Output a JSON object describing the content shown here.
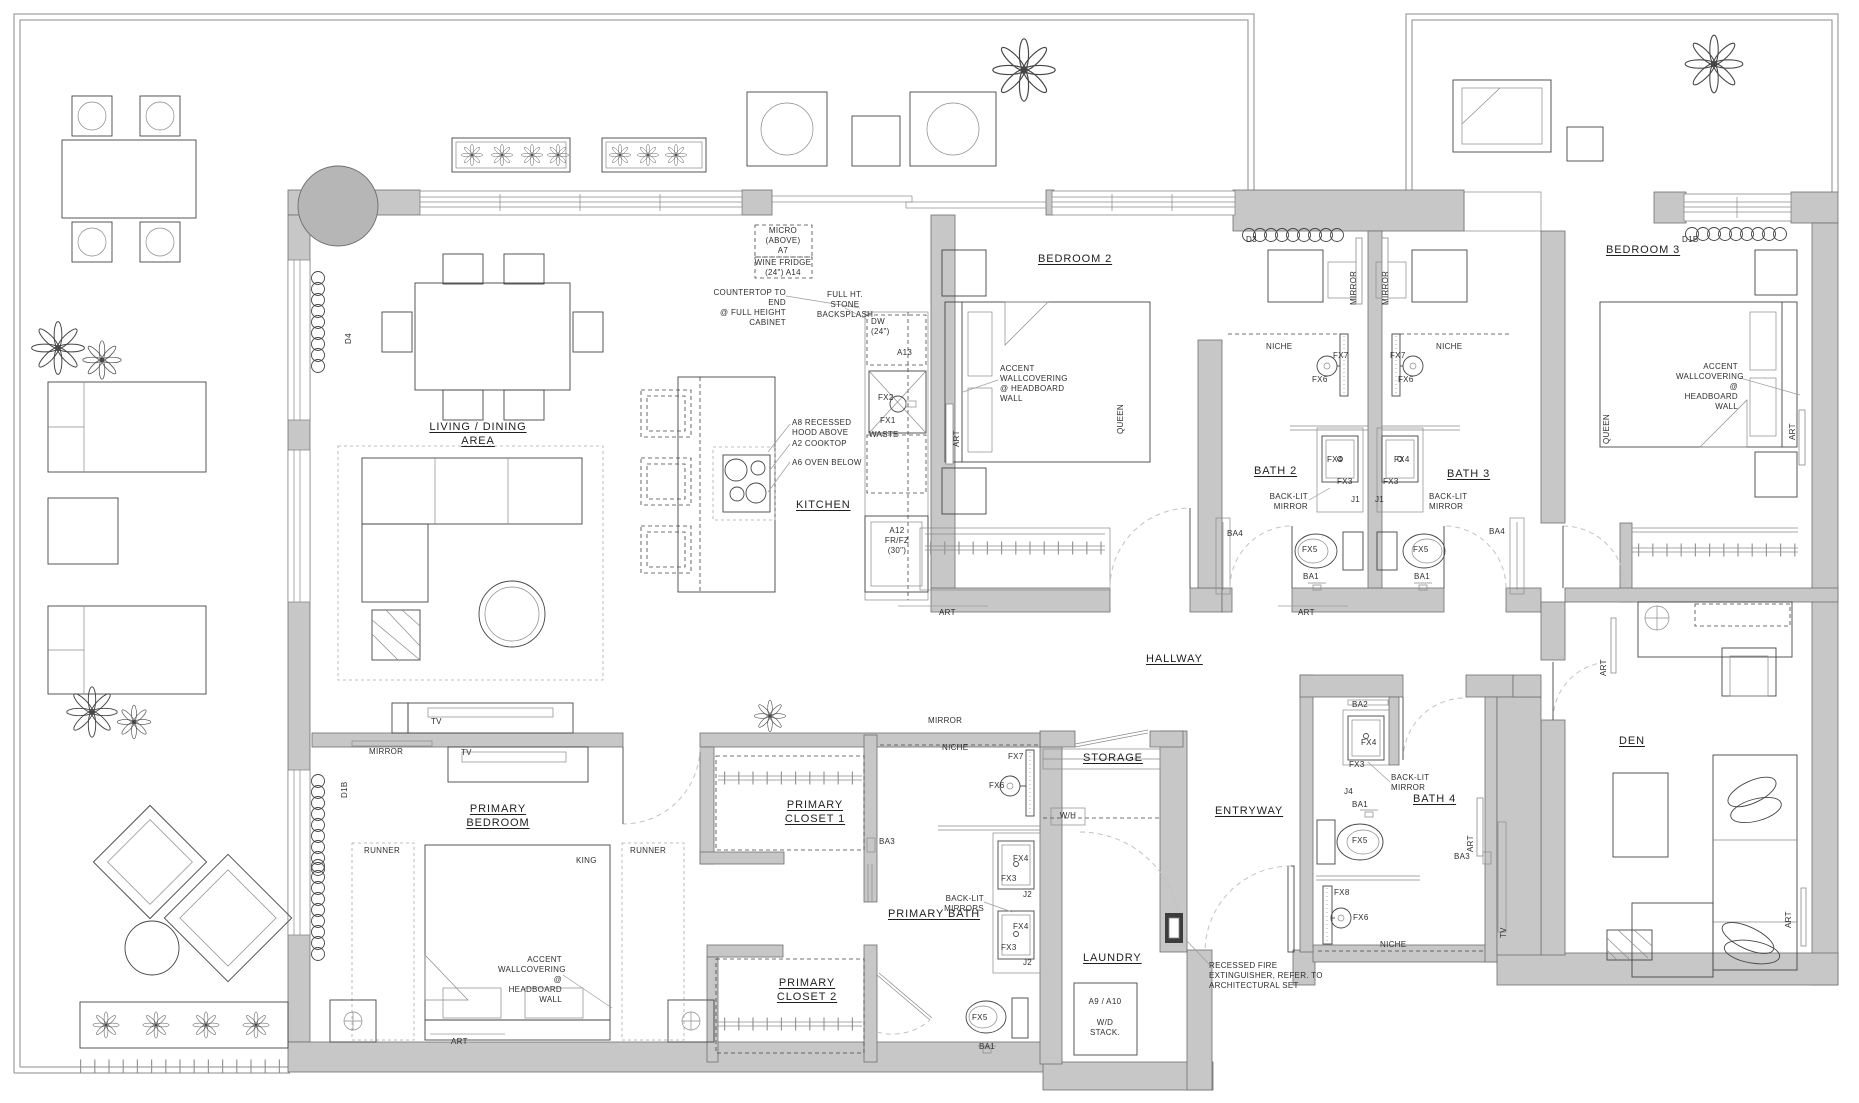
{
  "colors": {
    "wall_fill": "#c7c7c7",
    "line": "#454545",
    "plant_green": "#4f9f33",
    "door_swing": "#c2c2c2",
    "text": "#2e2e2e"
  },
  "rooms": {
    "living": "LIVING / DINING AREA",
    "kitchen": "KITCHEN",
    "bedroom2": "BEDROOM 2",
    "bedroom3": "BEDROOM 3",
    "bath2": "BATH 2",
    "bath3": "BATH 3",
    "bath4": "BATH 4",
    "primary_bedroom": "PRIMARY\nBEDROOM",
    "primary_closet1": "PRIMARY\nCLOSET 1",
    "primary_closet2": "PRIMARY\nCLOSET 2",
    "primary_bath": "PRIMARY BATH",
    "hallway": "HALLWAY",
    "storage": "STORAGE",
    "entryway": "ENTRYWAY",
    "laundry": "LAUNDRY",
    "den": "DEN"
  },
  "kitchen": {
    "micro": "MICRO\n(ABOVE)\nA7",
    "wine_fridge": "WINE FRIDGE\n(24\") A14",
    "countertop": "COUNTERTOP TO END\n@ FULL HEIGHT\nCABINET",
    "backsplash": "FULL HT. STONE\nBACKSPLASH",
    "dw": "DW\n(24\")",
    "a13": "A13",
    "fx2": "FX2",
    "fx1": "FX1",
    "waste": "WASTE",
    "fridge": "A12\nFR/FZ\n(30\")",
    "hood": "A8 RECESSED\nHOOD ABOVE",
    "cooktop": "A2 COOKTOP",
    "oven": "A6 OVEN BELOW"
  },
  "notes": {
    "accent": "ACCENT\nWALLCOVERING\n@ HEADBOARD\nWALL",
    "backlit": "BACK-LIT\nMIRROR",
    "backlit_plural": "BACK-LIT\nMIRRORS",
    "fire": "RECESSED FIRE\nEXTINGUISHER, REFER. TO\nARCHITECTURAL SET",
    "wd_unit": "A9 / A10",
    "wd_stack": "W/D\nSTACK.",
    "wh": "W/H"
  },
  "tags": {
    "fx1": "FX1",
    "fx2": "FX2",
    "fx3": "FX3",
    "fx4": "FX4",
    "fx5": "FX5",
    "fx6": "FX6",
    "fx7": "FX7",
    "fx8": "FX8",
    "ba1": "BA1",
    "ba2": "BA2",
    "ba3": "BA3",
    "ba4": "BA4",
    "j1": "J1",
    "j2": "J2",
    "j4": "J4",
    "niche": "NICHE",
    "mirror": "MIRROR",
    "art": "ART",
    "tv": "TV",
    "runner": "RUNNER",
    "king": "KING",
    "queen": "QUEEN",
    "d3": "D3",
    "d4": "D4",
    "d1b": "D1B"
  }
}
